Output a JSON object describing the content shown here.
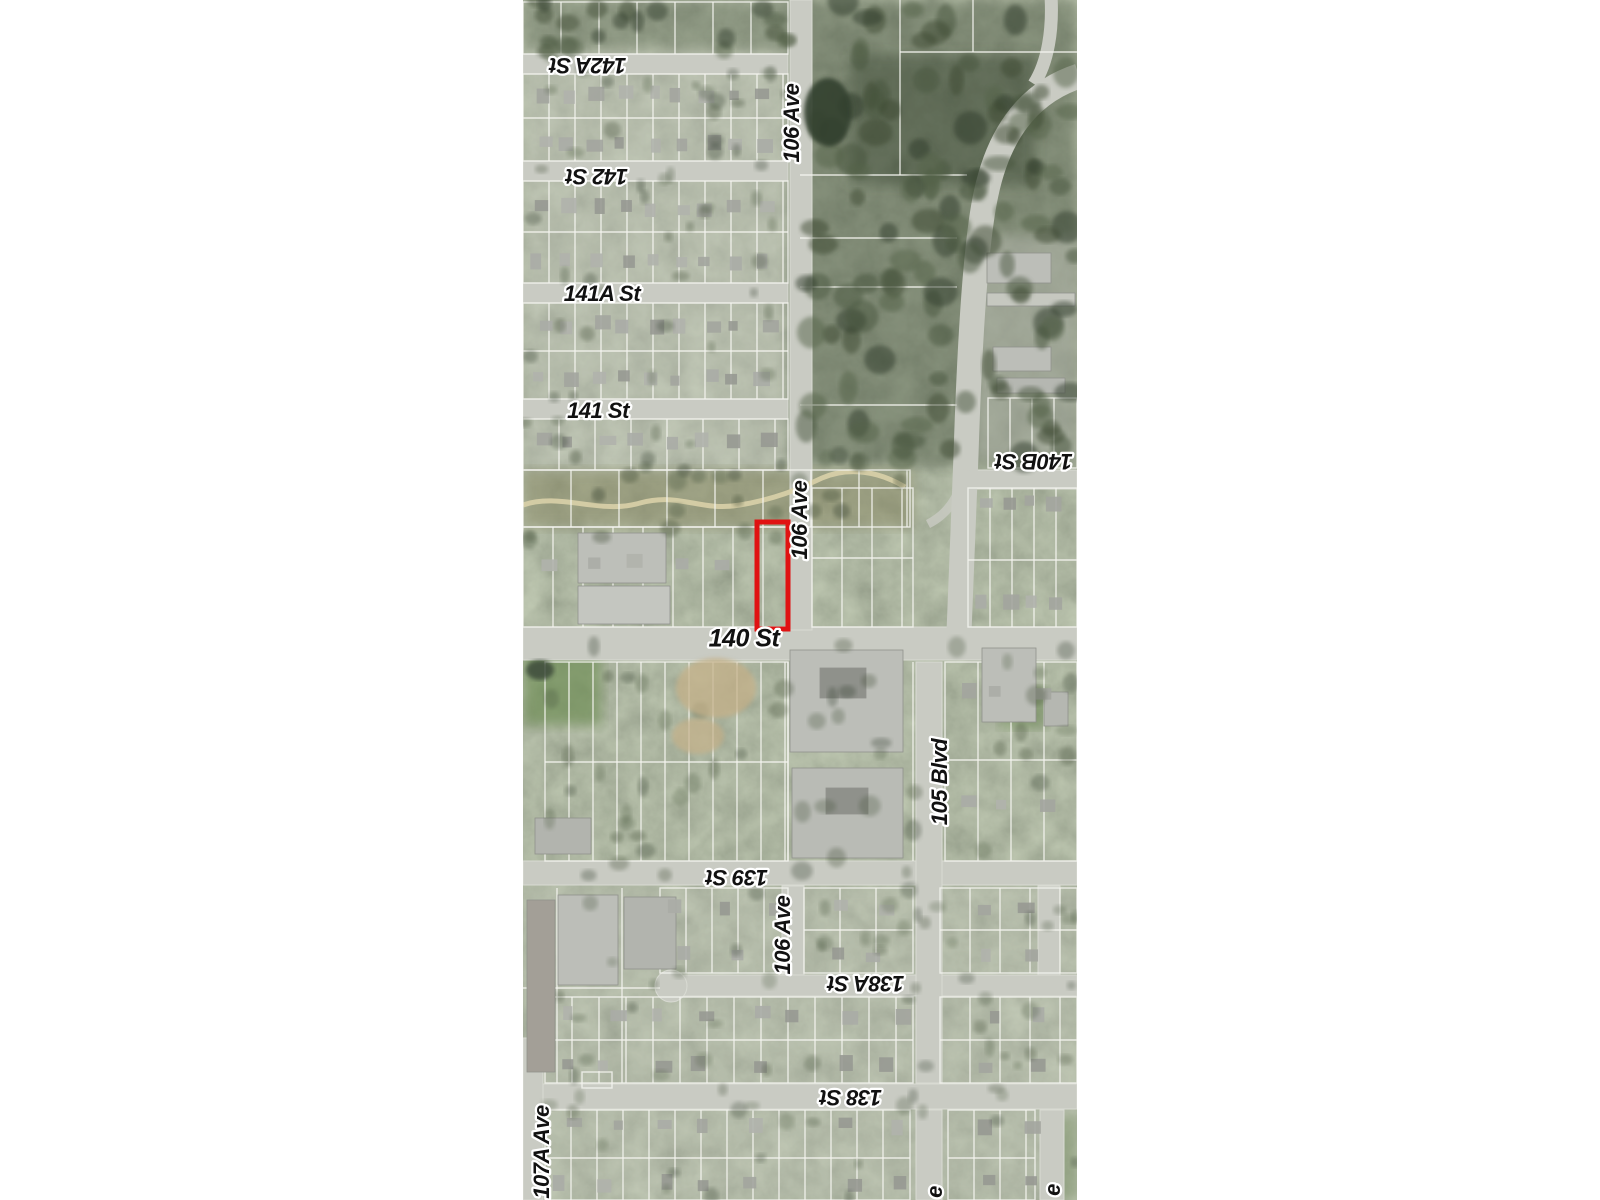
{
  "page": {
    "background": "#ffffff",
    "type": "aerial-parcel-map-image"
  },
  "map": {
    "area": {
      "left": 523,
      "top": 0,
      "width": 554,
      "height": 1200
    },
    "highlight": {
      "color": "#e01212",
      "x": 757,
      "y": 522,
      "width": 31,
      "height": 107,
      "stroke_width": 5
    },
    "palette": {
      "base": "#828a76",
      "forest": "#3f4d37",
      "street": "#c9cbc3",
      "street_edge": "#d9dbd3",
      "parcel_line": "#f5f5f0",
      "building": "#bcbeb8",
      "building_dark": "#8f918b",
      "greenbelt": "#8a8a66",
      "trail": "#d9d0a8",
      "dirt": "#c4b088",
      "field": "#6e8d55",
      "pond": "#333f2f",
      "label_ink": "#111111",
      "label_halo": "#ffffff"
    },
    "labels": [
      {
        "text": "142A St",
        "x": 588,
        "y": 64,
        "rot": 180,
        "size": 22
      },
      {
        "text": "106 Ave",
        "x": 793,
        "y": 123,
        "rot": -90,
        "size": 22
      },
      {
        "text": "142 St",
        "x": 597,
        "y": 175,
        "rot": 180,
        "size": 22
      },
      {
        "text": "141A St",
        "x": 602,
        "y": 295,
        "rot": 0,
        "size": 22
      },
      {
        "text": "141 St",
        "x": 598,
        "y": 412,
        "rot": 0,
        "size": 22
      },
      {
        "text": "140B St",
        "x": 1034,
        "y": 460,
        "rot": 180,
        "size": 22
      },
      {
        "text": "106 Ave",
        "x": 801,
        "y": 520,
        "rot": -90,
        "size": 22
      },
      {
        "text": "140 St",
        "x": 744,
        "y": 640,
        "rot": 0,
        "size": 25
      },
      {
        "text": "105 Blvd",
        "x": 941,
        "y": 782,
        "rot": -90,
        "size": 22
      },
      {
        "text": "139 St",
        "x": 737,
        "y": 876,
        "rot": 180,
        "size": 22
      },
      {
        "text": "106 Ave",
        "x": 784,
        "y": 935,
        "rot": -90,
        "size": 22
      },
      {
        "text": "138A St",
        "x": 866,
        "y": 982,
        "rot": 180,
        "size": 22
      },
      {
        "text": "138 St",
        "x": 851,
        "y": 1096,
        "rot": 180,
        "size": 22
      },
      {
        "text": "107A Ave",
        "x": 543,
        "y": 1152,
        "rot": -90,
        "size": 22
      },
      {
        "text": "e",
        "x": 936,
        "y": 1192,
        "rot": -90,
        "size": 22
      },
      {
        "text": "e",
        "x": 1054,
        "y": 1190,
        "rot": -90,
        "size": 22
      }
    ]
  }
}
